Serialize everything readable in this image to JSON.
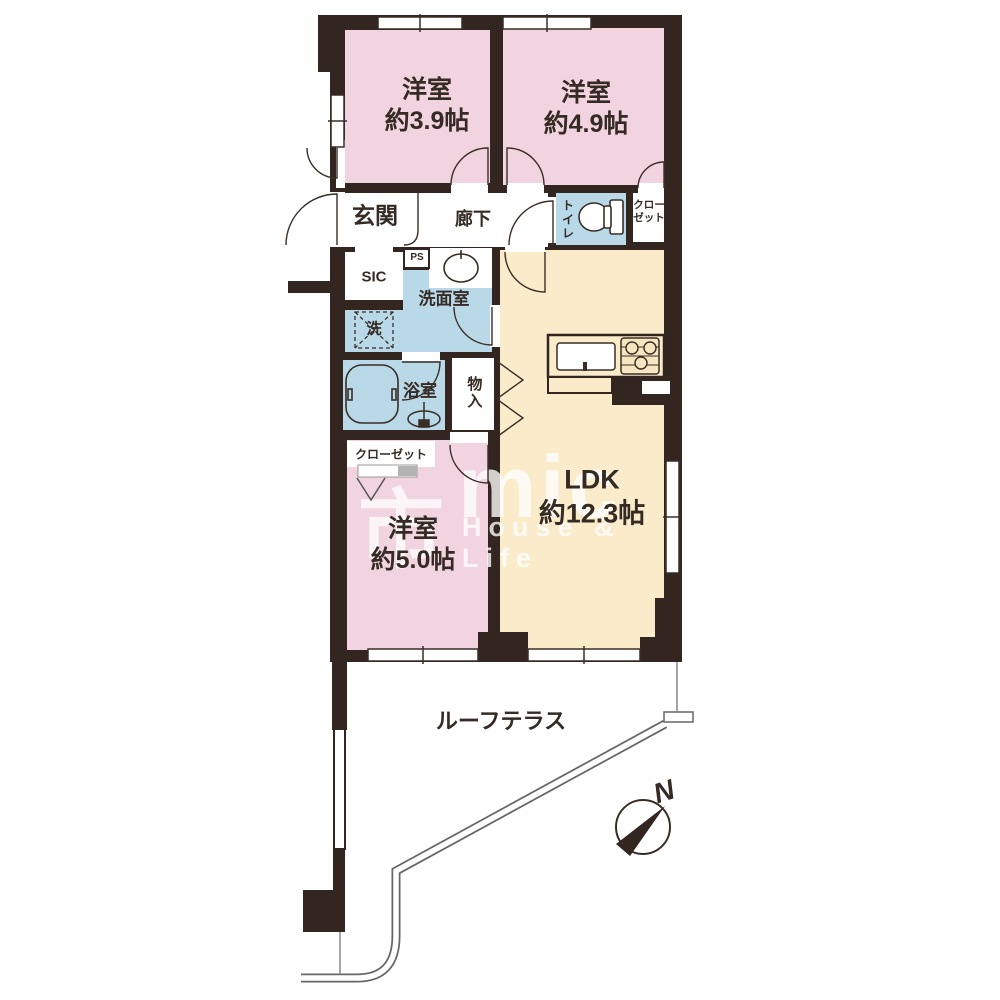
{
  "plan_title": "2LDK floor plan with roof terrace",
  "rooms": {
    "bedroom1": {
      "name": "洋室",
      "size": "約3.9帖"
    },
    "bedroom2": {
      "name": "洋室",
      "size": "約4.9帖"
    },
    "bedroom3": {
      "name": "洋室",
      "size": "約5.0帖"
    },
    "ldk": {
      "name": "LDK",
      "size": "約12.3帖"
    },
    "entrance": {
      "label": "玄関"
    },
    "hallway": {
      "label": "廊下"
    },
    "toilet": {
      "label": "トイレ"
    },
    "closet_upper": {
      "label": "クローゼット"
    },
    "closet_lower": {
      "label": "クローゼット"
    },
    "sic": {
      "label": "SIC"
    },
    "ps": {
      "label": "PS"
    },
    "washroom": {
      "label": "洗面室"
    },
    "washer": {
      "label": "洗"
    },
    "bathroom": {
      "label": "浴室"
    },
    "storage": {
      "label": "物入"
    },
    "terrace": {
      "label": "ルーフテラス"
    }
  },
  "compass": {
    "label": "N"
  },
  "watermark": {
    "mark": "市",
    "brand": "mic",
    "tagline": "House & Life"
  },
  "colors": {
    "wall": "#33251f",
    "bedroom_fill": "#f2d4e0",
    "wet_area_fill": "#b9d9e8",
    "ldk_fill": "#faeccb",
    "line": "#3a2d26",
    "terrace_line": "#666666",
    "shelf_gray": "#b3b3b3",
    "text": "#352b24"
  }
}
